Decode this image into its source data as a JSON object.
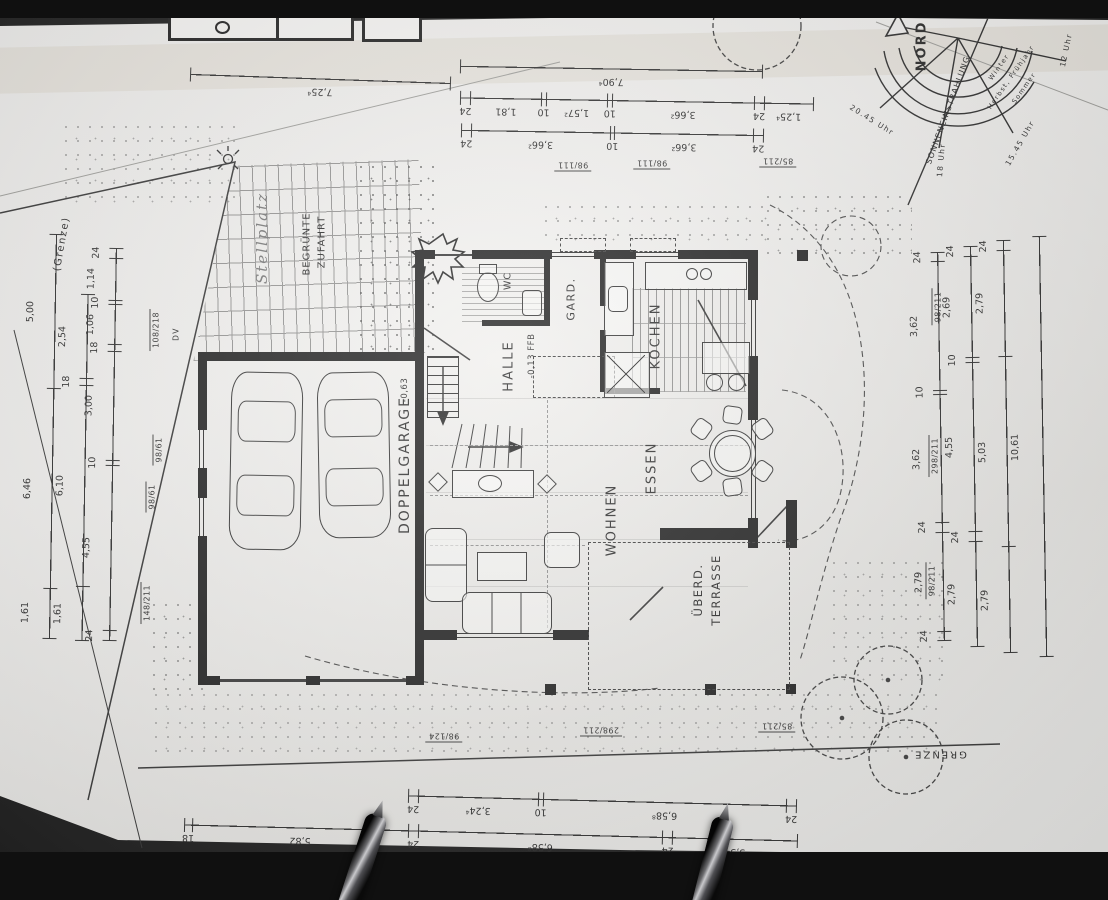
{
  "compass": {
    "north": "NORD",
    "sun": "SONNENEINSTRAHLUNG",
    "seasons": [
      "Winter",
      "Herbst, Frühjahr",
      "Sommer"
    ],
    "times": [
      "12 Uhr",
      "15.45 Uhr",
      "18 Uhr",
      "20.45 Uhr"
    ]
  },
  "boundary": {
    "left": "(Grenze)",
    "bottom": "GRENZE"
  },
  "site": {
    "driveway_line1": "BEGRÜNTE",
    "driveway_line2": "ZUFAHRT",
    "handwritten": "Stellplatz",
    "dv": "DV"
  },
  "rooms": {
    "garage": {
      "name": "DOPPELGARAGE",
      "level": "-0,63"
    },
    "halle": {
      "name": "HALLE",
      "level": "-0,13 FFB"
    },
    "wc": {
      "name": "WC"
    },
    "gard": {
      "name": "GARD."
    },
    "kochen": {
      "name": "KOCHEN"
    },
    "essen": {
      "name": "ESSEN"
    },
    "wohnen": {
      "name": "WOHNEN"
    },
    "terrasse": {
      "line1": "ÜBERD.",
      "line2": "TERRASSE"
    }
  },
  "dimensions": {
    "top": [
      [
        "7,25⁴"
      ],
      [
        "7,90⁴"
      ],
      [
        "1,25⁴",
        "24",
        "3,66²",
        "10",
        "1,57²",
        "10",
        "1,81",
        "24"
      ],
      [
        "24",
        "3,66²",
        "10",
        "3,66²",
        "24"
      ]
    ],
    "left": [
      [
        "5,00",
        "6,46",
        "1,61"
      ],
      [
        "2,54",
        "18",
        "6,10",
        "1,61"
      ],
      [
        "24",
        "1,14",
        "10",
        "1,06",
        "18",
        "3,00",
        "10",
        "4,55",
        "24"
      ]
    ],
    "right": [
      [
        "24",
        "3,62",
        "10",
        "3,62",
        "24",
        "2,79",
        "24"
      ],
      [
        "24",
        "2,69",
        "10",
        "4,55",
        "24",
        "2,79"
      ],
      [
        "24",
        "2,79",
        "5,03",
        "2,79"
      ],
      [
        "10,61"
      ]
    ],
    "bottom": [
      [
        "24",
        "6,58⁸",
        "10",
        "3,24⁴",
        "24"
      ],
      [
        "3,34",
        "24",
        "6,58⁸",
        "24",
        "5,82",
        "18"
      ],
      [
        "10,41²",
        "6,00"
      ]
    ]
  },
  "openings": {
    "top": [
      "98/111",
      "98/111",
      "85/211"
    ],
    "left": [
      "108/218",
      "98/61",
      "98/61",
      "148/211"
    ],
    "right": [
      "98/211",
      "298/211",
      "98/211"
    ],
    "bottom": [
      "98/124",
      "298/211",
      "85/211"
    ]
  }
}
